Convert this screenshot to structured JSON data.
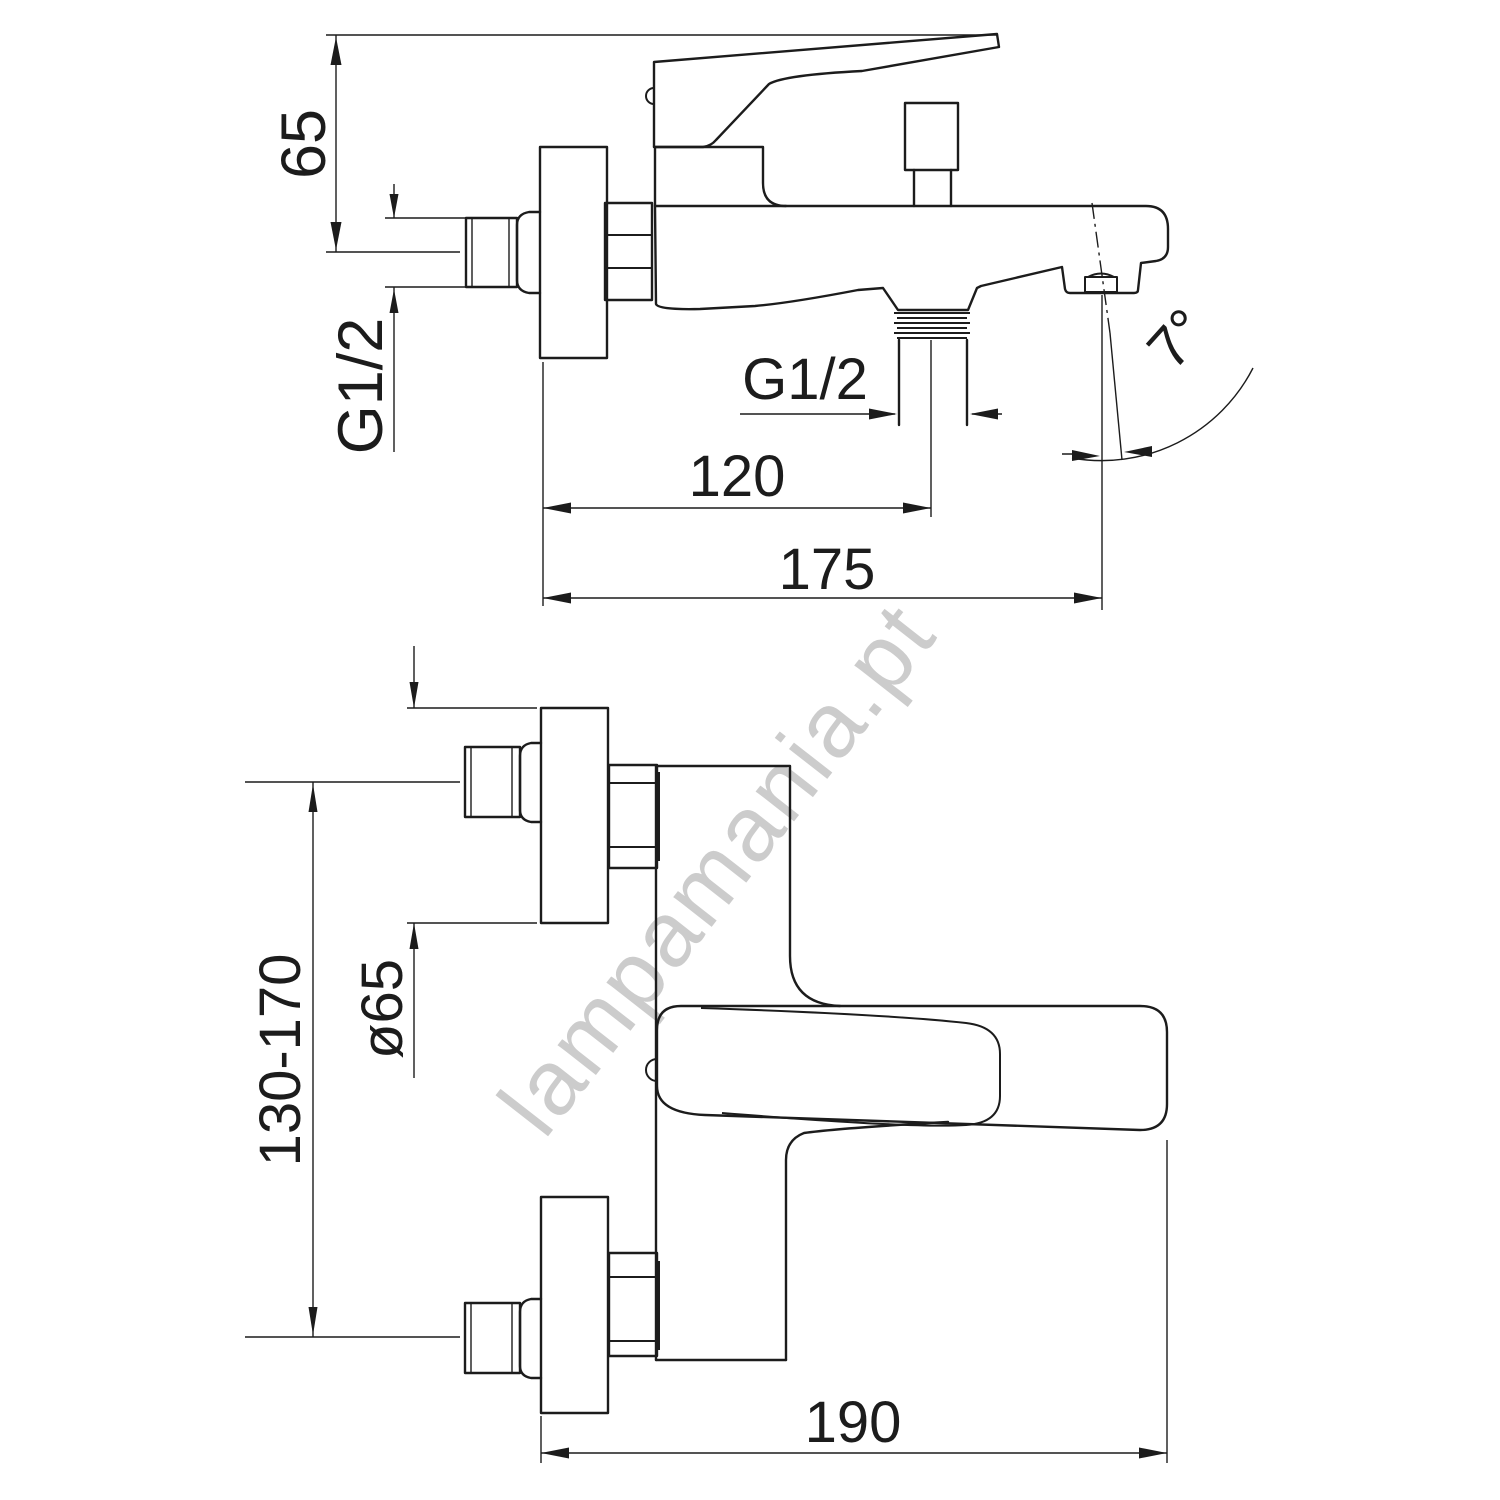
{
  "colors": {
    "line": "#1c1c1c",
    "background": "#ffffff",
    "watermark": "#cccccc"
  },
  "watermark": {
    "text": "lampamania.pt"
  },
  "side_view": {
    "dims": {
      "handle_height": "65",
      "inlet_thread": "G1/2",
      "outlet_thread": "G1/2",
      "outlet_offset": "120",
      "spout_reach": "175",
      "spout_angle": "7°"
    }
  },
  "front_view": {
    "dims": {
      "escutcheon_diameter": "ø65",
      "inlet_spacing": "130-170",
      "overall_width": "190"
    }
  }
}
